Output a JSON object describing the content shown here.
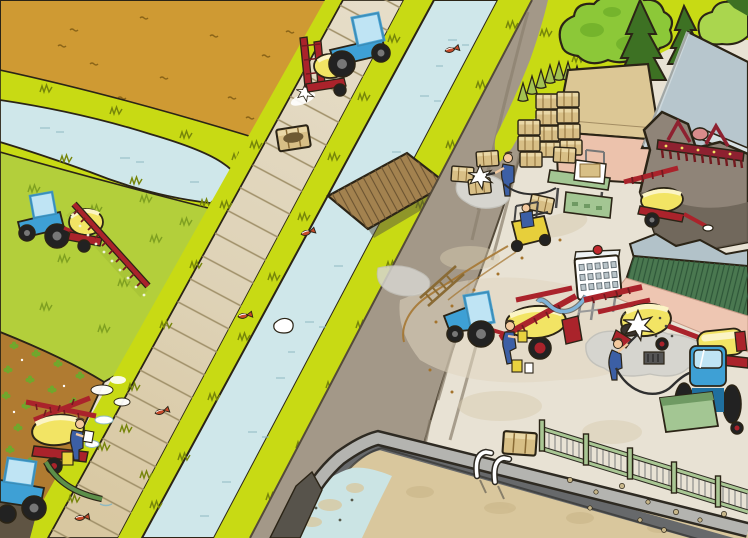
{
  "scene": {
    "title": "Cartoon aerial illustration of a farm: tractors spraying pesticide beside a canal with dead fish, a farmyard where sprayers are filled and washed, crate cleaning, a storage barn and a water basin",
    "regions": [
      {
        "name": "plowed-field",
        "label": "ochre plowed field, top left"
      },
      {
        "name": "pasture",
        "label": "green pasture with boom sprayer"
      },
      {
        "name": "vegetable-field",
        "label": "brown field with crop rows"
      },
      {
        "name": "ditch",
        "label": "small ditch ending near the road"
      },
      {
        "name": "slab-road",
        "label": "concrete slab road"
      },
      {
        "name": "canal",
        "label": "canal with floating dead fish"
      },
      {
        "name": "dirt-road",
        "label": "unpaved farm road"
      },
      {
        "name": "farmyard",
        "label": "paved farmyard"
      },
      {
        "name": "basin",
        "label": "water storage basin with ladder and fence"
      }
    ],
    "objects": [
      {
        "name": "road-tractor-sprayer",
        "label": "tractor spraying the road verge"
      },
      {
        "name": "field-tractor-sprayer",
        "label": "tractor with extended spray boom"
      },
      {
        "name": "filling-tractor-sprayer",
        "label": "sprayer filled from canal with suction hose"
      },
      {
        "name": "yard-tractor-sprayer",
        "label": "sprayer filled from water tank"
      },
      {
        "name": "washed-sprayer",
        "label": "sprayer washed over drain pad"
      },
      {
        "name": "rear-tractor-hopper",
        "label": "tractor with green hopper"
      },
      {
        "name": "forklift",
        "label": "forklift carrying crate"
      },
      {
        "name": "crate-washer",
        "label": "worker hosing crates"
      },
      {
        "name": "wooden-bridge",
        "label": "plank bridge over canal"
      },
      {
        "name": "barn",
        "label": "open barn with stored machinery"
      },
      {
        "name": "shed",
        "label": "shed with pink wall and crate stacks"
      },
      {
        "name": "ibc-water-tank",
        "label": "white water tank on frame"
      },
      {
        "name": "dead-fish",
        "label": "five dead fish in the water"
      }
    ],
    "counts": {
      "dead_fish": 5,
      "workers": 5,
      "tractors": 5
    }
  },
  "colors": {
    "outline": "#2b2416",
    "field": "#cf9a33",
    "fieldDash": "#8a6418",
    "grassBright": "#c8da14",
    "grassStroke": "#76850a",
    "pasture": "#b3cf3b",
    "pastureStroke": "#7fa021",
    "water": "#cfe7ea",
    "waterStroke": "#8fb9c2",
    "soil": "#b07b31",
    "plantGreen": "#6fa82c",
    "slabA": "#e6ddc8",
    "slabB": "#d8c7a0",
    "slabJoint": "#9f8f68",
    "dirtRoad": "#a39888",
    "dirtEdge": "#544a3a",
    "dirtStreak": "#8c816f",
    "plaza": "#e8e2d4",
    "stain": "#d6c9ad",
    "trackBrown": "#a4732c",
    "treeGreen": "#8cc838",
    "treeDark": "#63a424",
    "coniferDark": "#3d7123",
    "coniferSmall": "#a3c251",
    "bush": "#aad64e",
    "shedRoof": "#dcc795",
    "shedWallPink": "#ecc2ac",
    "barnRoof": "#b7c6cd",
    "barnRoofLight": "#d6e0e3",
    "barnIn": "#8f8478",
    "barnInDark": "#6c6357",
    "machineRed": "#8e2130",
    "machinePink": "#d98b8b",
    "wallCap": "#b2c2c9",
    "wallGreen": "#4a7850",
    "wallGreenDark": "#2e5638",
    "salmon": "#eec6b2",
    "basinRim": "#b4b4b0",
    "basinWall": "#67696b",
    "basinSand": "#d9c79d",
    "basinWater": "#cbe4e4",
    "fenceGreen": "#a9c794",
    "slatGray": "#9b9b97",
    "pebble": "#c7b68a",
    "bridgeWood": "#a3824f",
    "bridgeLine": "#6b5331",
    "tractorBlue": "#3ea0d5",
    "tractorBlueDark": "#1f6f9f",
    "cabGlass": "#bfe4f4",
    "wheelDark": "#222222",
    "hubGray": "#777777",
    "tankYellow": "#f2e464",
    "tankCream": "#fbf4c4",
    "frameRed": "#aa232b",
    "frameRedDark": "#731a1f",
    "overalls": "#3c5fa5",
    "skin": "#f3c99e",
    "crateTan": "#d8bf86",
    "crateDark": "#8a6b35",
    "stationGreen": "#a3c693",
    "stationGreenDark": "#6f9a63",
    "forkliftYellow": "#e7cf3b",
    "white": "#ffffff",
    "puddle": "#d6d5cf",
    "puddleDark": "#c3c2bb",
    "hoseGreen": "#5c8f4a",
    "hoseBlue": "#7fb3d8",
    "hoseDark": "#2f2f2f",
    "fishRed": "#c64a2a",
    "jerryYellow": "#e8d23f"
  }
}
